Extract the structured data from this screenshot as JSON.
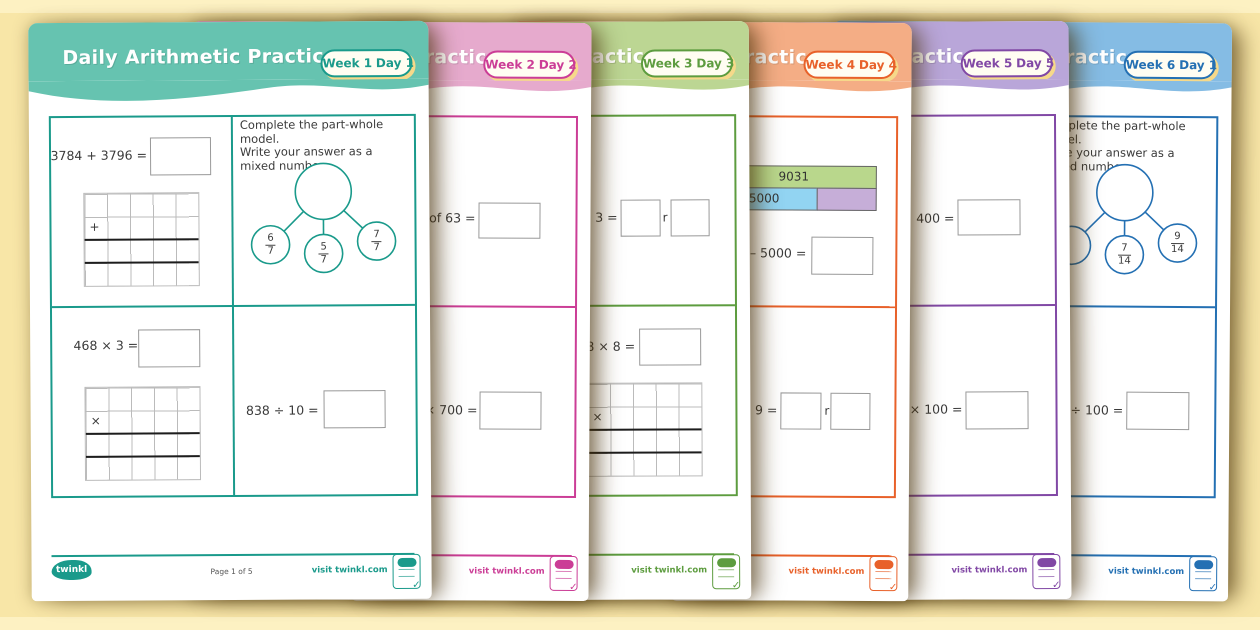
{
  "canvas_bg": "#f8e6a7",
  "badge_shadow": "#f6d98a",
  "pages": [
    {
      "title": "Daily Arithmetic Practice",
      "week": "Week 1",
      "day": "Day 1",
      "header_bg": "#66c3b0",
      "accent": "#1a9a8b",
      "q_add": "3784 + 3796 =",
      "op_add": "+",
      "q_mul": "468 × 3 =",
      "op_mul": "×",
      "q_div": "838 ÷ 10 =",
      "instruction_lines": [
        "Complete the part-whole model.",
        "Write your answer as a",
        "mixed number."
      ],
      "fractions": [
        {
          "n": "6",
          "d": "7"
        },
        {
          "n": "5",
          "d": "7"
        },
        {
          "n": "7",
          "d": "7"
        }
      ],
      "footer": {
        "logo": "twinkl",
        "page_label": "Page 1 of 5",
        "visit": "visit twinkl.com"
      }
    },
    {
      "title": "Daily Arithmetic Practice",
      "week": "Week 2",
      "day": "Day 2",
      "header_bg": "#e6aacd",
      "accent": "#cb3d96",
      "q_top": "of 63 =",
      "q_bottom": "× 700 =",
      "footer": {
        "visit": "visit twinkl.com"
      }
    },
    {
      "title": "Daily Arithmetic Practice",
      "week": "Week 3",
      "day": "Day 3",
      "header_bg": "#bcd693",
      "accent": "#5d9c3f",
      "q_top": "÷ 3 =",
      "remainder_label": "r",
      "q_bottom": "58 × 8 =",
      "op_mul": "×",
      "footer": {
        "visit": "visit twinkl.com"
      }
    },
    {
      "title": "Daily Arithmetic Practice",
      "week": "Week 4",
      "day": "Day 4",
      "header_bg": "#f4ad85",
      "accent": "#e8612a",
      "bar_total": "9031",
      "bar_part": "5000",
      "bar_total_color": "#b9d78c",
      "bar_part_color": "#92d4f2",
      "bar_unknown_color": "#c6aed8",
      "q_mid": "1 – 5000 =",
      "q_bottom": "÷ 9 =",
      "remainder_label": "r",
      "footer": {
        "visit": "visit twinkl.com"
      }
    },
    {
      "title": "Daily Arithmetic Practice",
      "week": "Week 5",
      "day": "Day 5",
      "header_bg": "#b9a6d9",
      "accent": "#8148a5",
      "q_top": "× 400 =",
      "q_bottom": "6 × 100 =",
      "footer": {
        "visit": "visit twinkl.com"
      }
    },
    {
      "title": "Daily Arithmetic Practice",
      "week": "Week 6",
      "day": "Day 1",
      "header_bg": "#85bce4",
      "accent": "#2470b3",
      "instruction_lines": [
        "Complete the part-whole model.",
        "Write your answer as a",
        "mixed number."
      ],
      "fractions": [
        {
          "n": "7",
          "d": "14"
        },
        {
          "n": "9",
          "d": "14"
        }
      ],
      "q_bottom": "00 ÷ 100 =",
      "footer": {
        "visit": "visit twinkl.com"
      }
    }
  ]
}
